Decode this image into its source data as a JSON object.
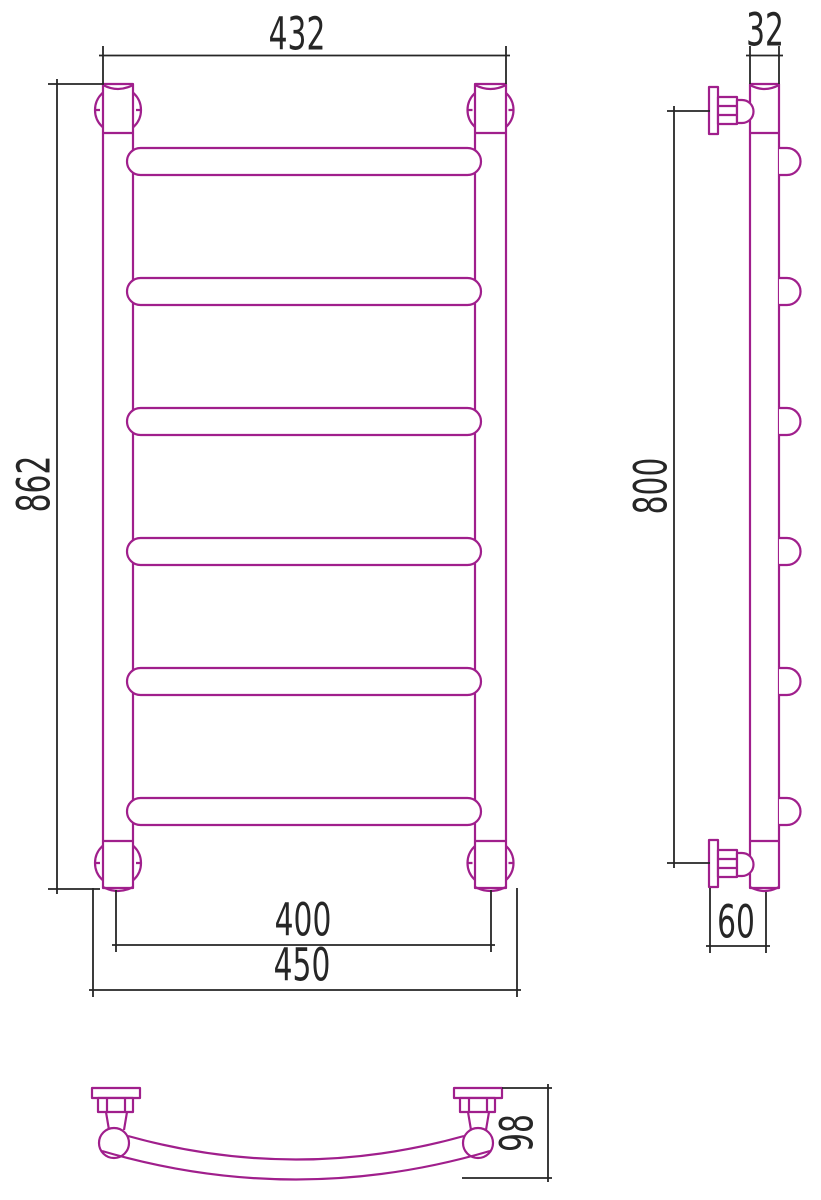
{
  "colors": {
    "outline": "#A01F8C",
    "dimension": "#262626",
    "background": "#FFFFFF"
  },
  "views": {
    "front": {
      "rung_count": 6,
      "dimensions": {
        "top_width": "432",
        "height": "862",
        "pipe_axis_width": "400",
        "overall_width": "450"
      }
    },
    "side": {
      "rung_count": 6,
      "dimensions": {
        "pipe_width": "32",
        "mount_height": "800",
        "wall_depth": "60"
      }
    },
    "top": {
      "dimensions": {
        "rail_depth": "98"
      }
    }
  }
}
